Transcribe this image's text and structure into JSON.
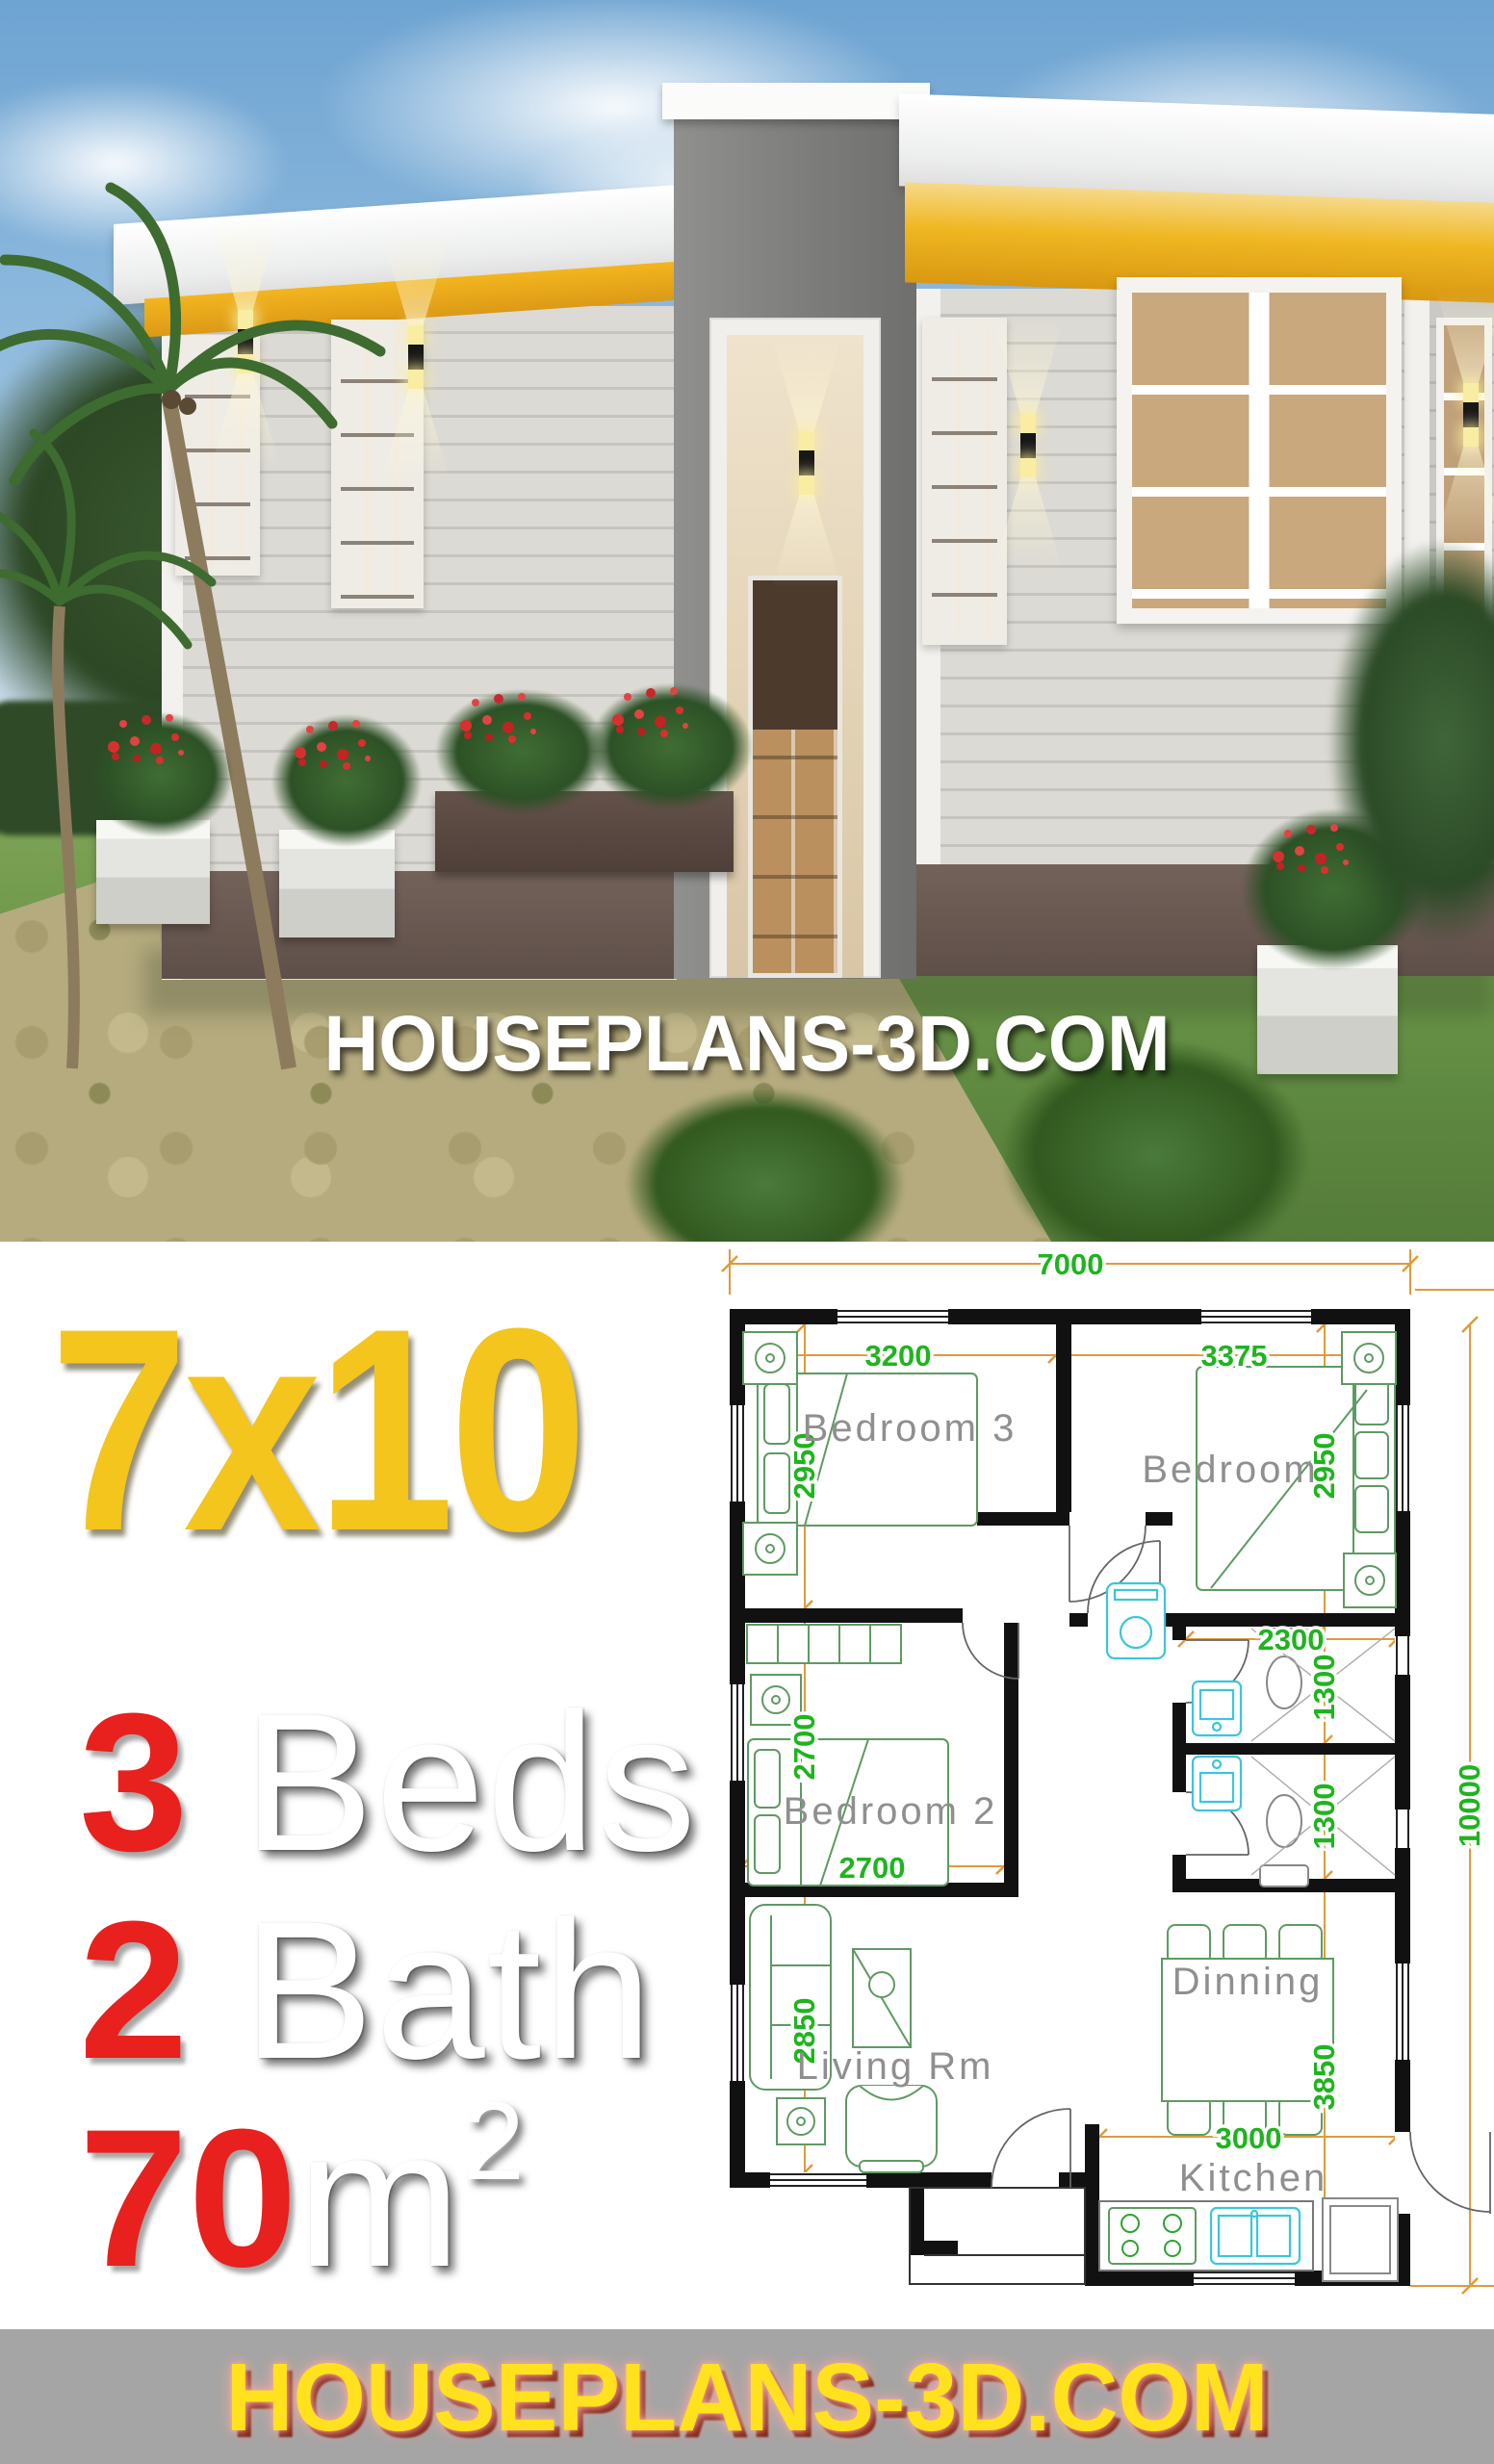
{
  "branding": {
    "photo_overlay_text": "HOUSEPLANS-3D.COM",
    "banner_text": "HOUSEPLANS-3D.COM"
  },
  "title": "7x10",
  "specs": [
    {
      "value": "3",
      "label": "Beds"
    },
    {
      "value": "2",
      "label": "Bath"
    },
    {
      "value": "70",
      "label": "m",
      "sup": "2"
    }
  ],
  "floor_plan": {
    "overall": {
      "width_mm": "7000",
      "depth_mm": "10000"
    },
    "rooms": {
      "bedroom3": "Bedroom 3",
      "bedroom": "Bedroom",
      "bedroom2": "Bedroom 2",
      "living": "Living Rm",
      "dining": "Dinning",
      "kitchen": "Kitchen"
    },
    "dimensions": {
      "top_total": "7000",
      "bedroom3_width": "3200",
      "bedroom_width": "3375",
      "bedroom3_depth": "2950",
      "bedroom_depth": "2950",
      "bath_width": "2300",
      "bath1_depth": "1300",
      "bath2_depth": "1300",
      "bedroom2_depth": "2700",
      "bedroom2_width": "2700",
      "living_depth": "2850",
      "dining_kitchen_depth": "3850",
      "kitchen_width": "3000",
      "right_total": "10000"
    }
  },
  "colors": {
    "title_yellow": "#F3C51D",
    "accent_red": "#E8201E",
    "banner_bg": "#A5A5A5",
    "banner_yellow": "#FFE11D",
    "banner_glow": "#F2A29B",
    "dim_line_orange": "#DE9B3C",
    "dim_text_green": "#1FB41F",
    "fixture_cyan": "#3BC6D8",
    "furniture_green": "#5E9A62",
    "wall_black": "#111111",
    "room_label_gray": "#8F8F8F",
    "soffit_yellow": "#E9A81F"
  }
}
